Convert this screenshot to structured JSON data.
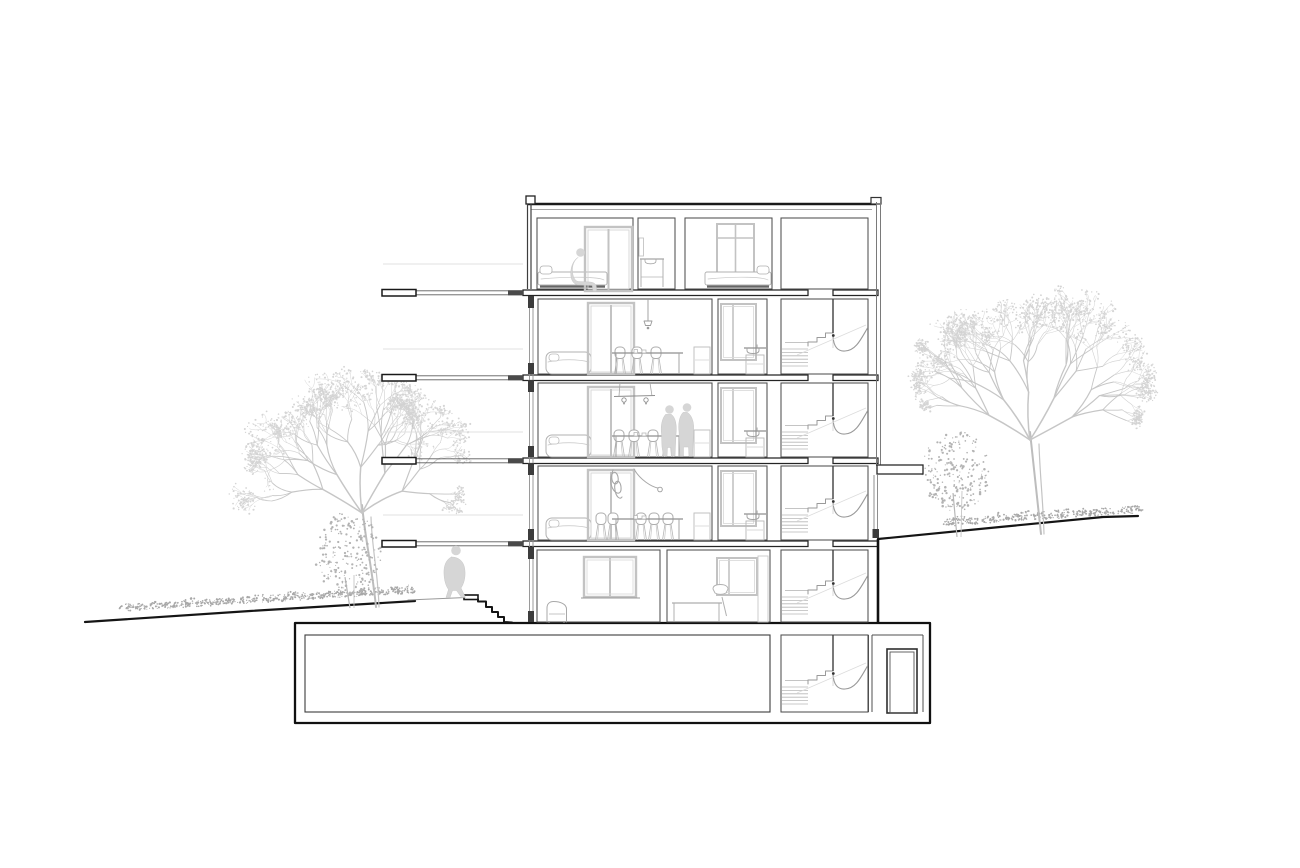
{
  "meta": {
    "type": "architectural-section-drawing",
    "title": "Multi-storey residential building - cross section with site trees",
    "visible_text": "none"
  },
  "canvas": {
    "width": 1300,
    "height": 868,
    "background": "#ffffff"
  },
  "palette": {
    "outline_heavy": "#111111",
    "wall": "#3d3d3d",
    "room_stroke": "#4f4f4f",
    "thin_wall": "#7a7a7a",
    "glazing": "#8f8f8f",
    "furniture": "#b0b0b0",
    "furniture_light": "#c6c6c6",
    "window_frame": "#c3c3c3",
    "silhouette_fill": "#d6d6d6",
    "silhouette_stroke": "#c8c8c8",
    "tree_branch": "#c6c6c6",
    "leaf_dot": "#d5d5d5",
    "bush_dot": "#b3b3b3",
    "hedge_dot": "#a8a8a8",
    "ground": "#151515",
    "stair_detail": "#999999",
    "slab_stroke": "#242424",
    "dark_cap": "#3c3c3c"
  },
  "building": {
    "roof": {
      "y": 203,
      "x1": 527,
      "x2": 876,
      "parapet_left": [
        526,
        196,
        9,
        8
      ],
      "parapet_right": [
        871,
        197.5,
        10,
        6.5
      ]
    },
    "slabs": [
      290,
      375,
      458,
      541
    ],
    "slab_seg1": [
      523,
      808
    ],
    "slab_seg2": [
      833,
      878
    ],
    "left_wall_attic": {
      "x1": 527.5,
      "x2": 531,
      "y1": 204,
      "y2": 289
    },
    "left_glazing": {
      "x1": 529.5,
      "x2": 533,
      "y1": 296,
      "y2": 622
    },
    "right_wall": {
      "x1": 876.5,
      "x2": 880.5,
      "y1": 202,
      "y2": 466
    },
    "floors": [
      {
        "id": "attic",
        "kind": "attic",
        "top": 218,
        "bottom": 289,
        "rooms": [
          [
            537,
            633
          ],
          [
            638,
            675
          ],
          [
            685,
            772
          ]
        ]
      },
      {
        "id": "level-3",
        "kind": "living",
        "top": 299,
        "bottom": 374,
        "rooms": [
          [
            538,
            712
          ],
          [
            718,
            767
          ]
        ],
        "light": "pendant",
        "people": false,
        "chairs": [
          620,
          637,
          656
        ]
      },
      {
        "id": "level-2",
        "kind": "living",
        "top": 383,
        "bottom": 457,
        "rooms": [
          [
            538,
            712
          ],
          [
            718,
            767
          ]
        ],
        "light": "track",
        "people": true,
        "chairs": [
          619,
          634,
          653,
          668
        ]
      },
      {
        "id": "level-1",
        "kind": "living",
        "top": 466,
        "bottom": 540,
        "rooms": [
          [
            538,
            712
          ],
          [
            718,
            767
          ]
        ],
        "light": "squiggle",
        "people": false,
        "chairs": [
          601,
          613,
          641,
          654,
          668
        ]
      },
      {
        "id": "garden",
        "kind": "garden",
        "top": 550,
        "bottom": 622,
        "rooms": [
          [
            537,
            660
          ],
          [
            667,
            770
          ]
        ]
      }
    ],
    "stairwell": {
      "x1": 781,
      "x2": 868,
      "open_x": 833,
      "attic_box": [
        218,
        289
      ],
      "flights": [
        {
          "top": 299,
          "fb": 374
        },
        {
          "top": 383,
          "fb": 457
        },
        {
          "top": 466,
          "fb": 540
        },
        {
          "top": 550,
          "fb": 622
        },
        {
          "top": 635,
          "fb": 712
        }
      ]
    },
    "balconies": {
      "x_tip": 382,
      "x_wall": 523,
      "cap_w": 34,
      "levels": [
        290,
        375,
        458,
        541
      ]
    },
    "basement": {
      "outer": [
        295,
        623,
        930,
        723
      ],
      "cellar": [
        305,
        635,
        770,
        712
      ],
      "stairbox": [
        781,
        635,
        868,
        712
      ],
      "lobby_wall_x": 868,
      "lobby_inner_x": 923,
      "door": [
        887,
        649,
        30,
        64
      ]
    },
    "entrance_right": {
      "canopy": [
        877,
        465,
        46,
        9
      ],
      "glazing_x": [
        874,
        877.5
      ],
      "glazing_y": [
        475,
        538
      ],
      "cap": [
        872.5,
        529,
        6.5,
        9
      ],
      "below_grade_wall": [
        878,
        539,
        878,
        623
      ]
    }
  },
  "site": {
    "ground_left": {
      "pts": [
        [
          85,
          622
        ],
        [
          250,
          611
        ],
        [
          415,
          601
        ]
      ],
      "light_path": [
        [
          408,
          600
        ],
        [
          466,
          597.5
        ]
      ]
    },
    "steps_left": {
      "landing": [
        464,
        595,
        14,
        4.5
      ],
      "steps": [
        [
          478,
          599.5
        ],
        [
          478,
          601.5
        ],
        [
          486,
          601.5
        ],
        [
          486,
          607
        ],
        [
          492,
          607
        ],
        [
          492,
          612
        ],
        [
          498,
          612
        ],
        [
          498,
          617
        ],
        [
          504,
          617
        ],
        [
          504,
          622
        ],
        [
          512,
          622.5
        ]
      ]
    },
    "ground_right": {
      "pts": [
        [
          878,
          539
        ],
        [
          1000,
          527
        ],
        [
          1103,
          517
        ],
        [
          1138,
          516
        ]
      ]
    },
    "trees": [
      {
        "id": "tree-large-left",
        "kind": "branchy",
        "base": [
          373,
          607
        ],
        "trunk_top": [
          362,
          505
        ],
        "canopy": [
          330,
          460,
          142,
          88
        ],
        "seed": 7
      },
      {
        "id": "bush-left",
        "kind": "round",
        "base": [
          350,
          608
        ],
        "canopy": [
          348,
          554,
          33,
          42
        ],
        "seed": 3
      },
      {
        "id": "tree-large-right",
        "kind": "branchy",
        "base": [
          1038,
          534
        ],
        "trunk_top": [
          1030,
          432
        ],
        "canopy": [
          1034,
          372,
          118,
          92
        ],
        "seed": 11
      },
      {
        "id": "tree-small-right",
        "kind": "round",
        "base": [
          957,
          537
        ],
        "canopy": [
          956,
          471,
          34,
          40
        ],
        "seed": 5
      }
    ],
    "hedges": [
      {
        "id": "hedge-left",
        "from": [
          128,
          616
        ],
        "to": [
          408,
          598
        ],
        "height": 20,
        "seed": 21
      },
      {
        "id": "hedge-right",
        "from": [
          948,
          530
        ],
        "to": [
          1136,
          517
        ],
        "height": 18,
        "seed": 22
      }
    ]
  },
  "figures": [
    {
      "id": "figure-walking-garden",
      "head": [
        456,
        550.5,
        4.8
      ],
      "path": "M451.5,557 C446,559.5 443.5,566 444,574 C444.3,581 446,586 448.5,589.5 L446,597.5 L450,597.5 L452.5,590.5 L456.5,590.5 L461.5,597.5 L465.5,597.5 L461,588 C464.5,583 466,575 464.5,567.5 C463,560.5 458,557 451.5,557 Z"
    },
    {
      "id": "figure-sitting-attic-bed",
      "head": [
        580.5,
        252.5,
        4.3
      ],
      "path": "M578,257.5 C574,260.5 572,265.5 572.5,271.5 C572.8,276.5 574.5,280.5 578,281.5 L590,282 C594.5,282.5 596.5,284.5 596.5,288 L596.5,291.5 L593,291.5 L592.3,285.5 L577.5,284.8 C572.8,283.8 570.5,279 570.8,272.5 C571,265.5 574,259.8 578,257.5 Z"
    },
    {
      "id": "figure-standing-left",
      "head": [
        669.5,
        409.5,
        4.3
      ],
      "path": "M665.5,414.5 C662,418.5 660.5,426 661.5,434 L662,447 L663.5,456.5 L667,456.5 L667.5,447.5 L671,447.5 L671.5,456.5 L675,456.5 L676,434 C677,425 675.5,417.5 671.5,414.5 Z"
    },
    {
      "id": "figure-standing-right",
      "head": [
        687,
        407.5,
        4.3
      ],
      "path": "M683,412.5 C679.5,416 678,423.5 679,431.5 L680,456.5 L683.5,456.5 L683.5,447 L688.5,447 L689,456.5 L692.5,456.5 L693.5,431 C694.5,422 691.5,415 687.5,412.5 Z"
    }
  ]
}
